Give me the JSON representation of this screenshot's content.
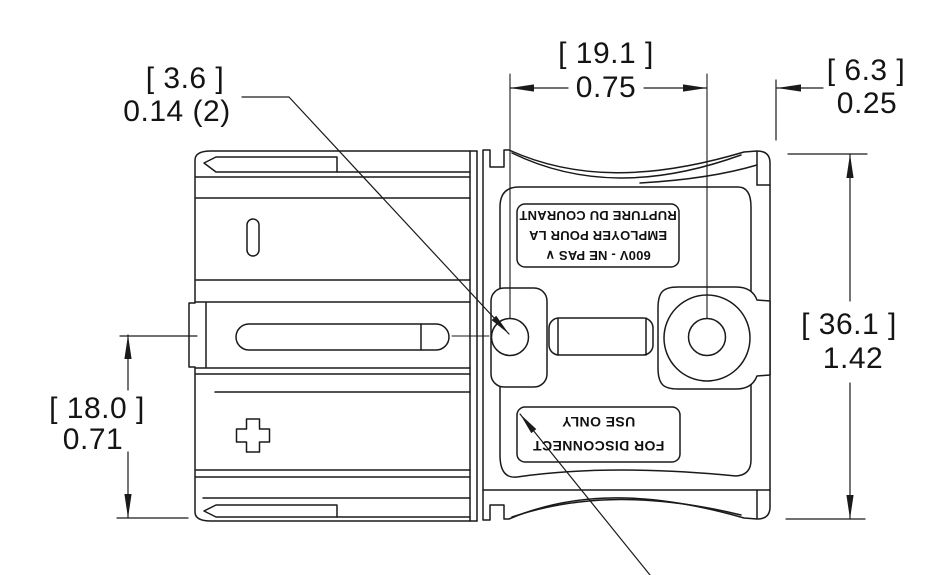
{
  "drawing": {
    "type": "engineering-dimension-drawing",
    "colors": {
      "line": "#1a1a1a",
      "background": "#ffffff"
    },
    "dimensions": {
      "slot_hole_dia": {
        "metric": "[ 3.6 ]",
        "imperial": "0.14 (2)"
      },
      "hole_spacing": {
        "metric": "[ 19.1 ]",
        "imperial": "0.75"
      },
      "right_offset": {
        "metric": "[ 6.3 ]",
        "imperial": "0.25"
      },
      "overall_height": {
        "metric": "[ 36.1 ]",
        "imperial": "1.42"
      },
      "lower_height": {
        "metric": "[ 18.0 ]",
        "imperial": "0.71"
      }
    },
    "labels": {
      "voltage_warning": {
        "orientation": "rotated-180",
        "line1": "600V - NE PAS ∨",
        "line2": "EMPLOYER POUR LA",
        "line3": "RUPTURE DU COURANT"
      },
      "disconnect_warning": {
        "orientation": "rotated-180",
        "line1": "FOR DISCONNECT",
        "line2": "USE ONLY"
      }
    }
  }
}
